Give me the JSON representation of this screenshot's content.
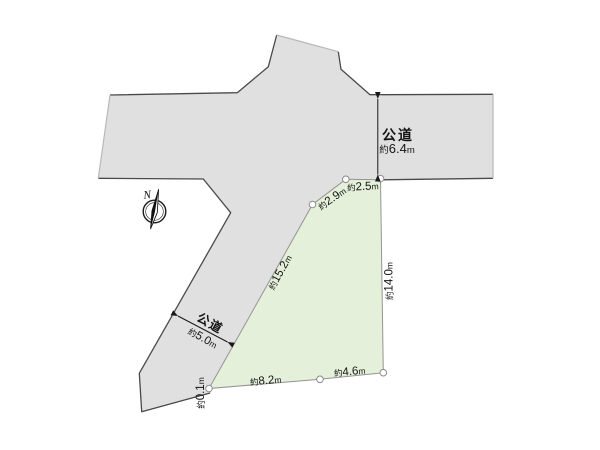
{
  "diagram": {
    "kind": "land-plot-site-plan",
    "background_color": "#ffffff",
    "road_fill_color": "#e0e0e0",
    "plot_fill_color": "#e5f0da",
    "outline_dark_color": "#4a4a4a",
    "outline_light_color": "#b8b8b8",
    "plot_outline_color": "#949494",
    "text_color": "#141414"
  },
  "roads": {
    "east_road": {
      "name": "公道",
      "width": {
        "prefix": "約",
        "value": "6.4",
        "unit": "m"
      }
    },
    "southwest_road": {
      "name": "公道",
      "width": {
        "prefix": "約",
        "value": "5.0",
        "unit": "m"
      }
    }
  },
  "plot": {
    "dimensions": {
      "north_a": {
        "prefix": "約",
        "value": "2.5",
        "unit": "m"
      },
      "north_b": {
        "prefix": "約",
        "value": "2.9",
        "unit": "m"
      },
      "west": {
        "prefix": "約",
        "value": "15.2",
        "unit": "m"
      },
      "east": {
        "prefix": "約",
        "value": "14.0",
        "unit": "m"
      },
      "south_b": {
        "prefix": "約",
        "value": "4.6",
        "unit": "m"
      },
      "south_a": {
        "prefix": "約",
        "value": "8.2",
        "unit": "m"
      },
      "southwest_tip": {
        "prefix": "約",
        "value": "0.1",
        "unit": "m"
      }
    }
  },
  "compass": {
    "north_label": "N"
  }
}
